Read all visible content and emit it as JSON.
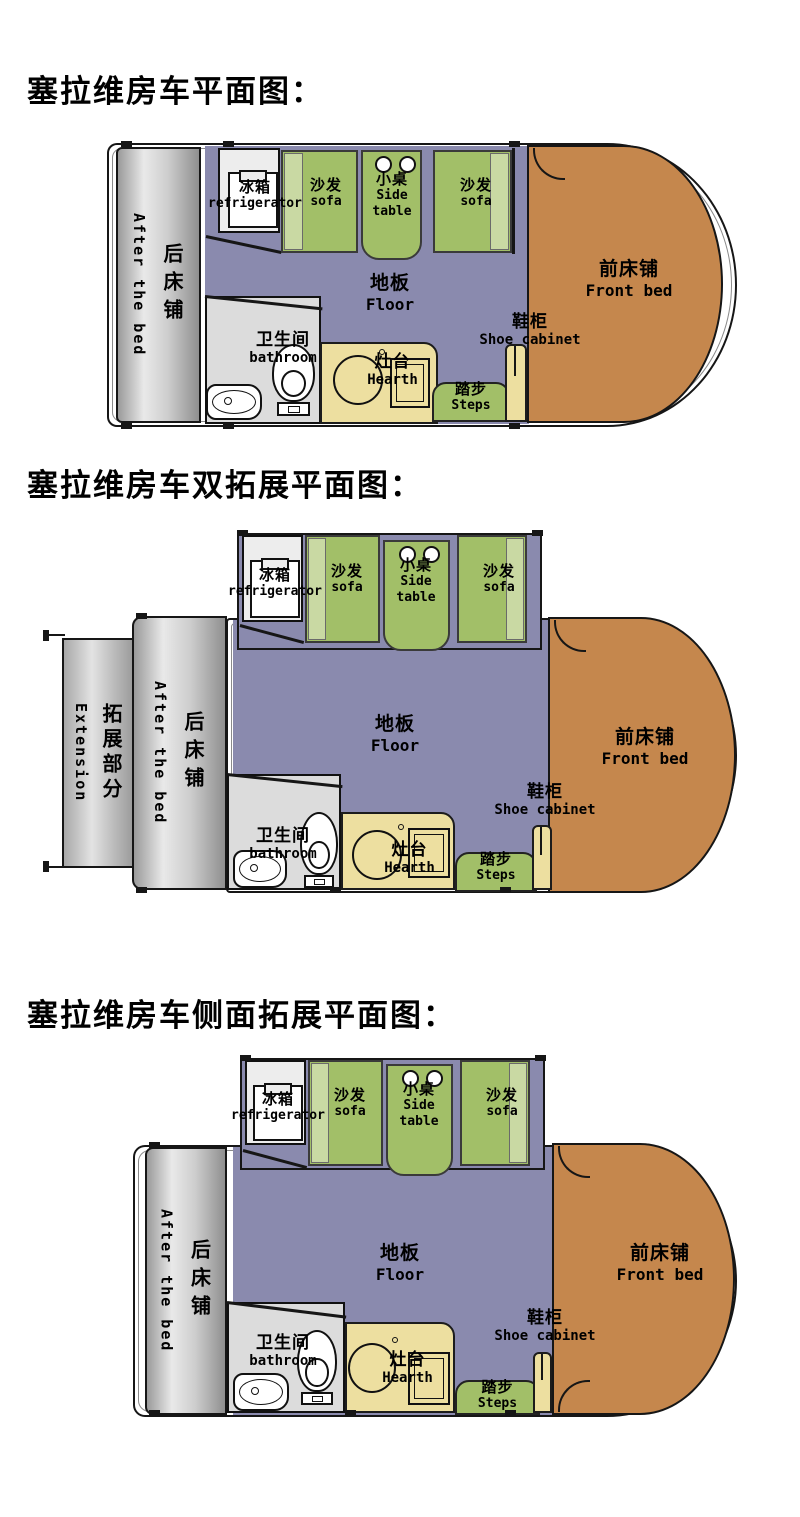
{
  "titles": {
    "plan1": "塞拉维房车平面图：",
    "plan2": "塞拉维房车双拓展平面图：",
    "plan3": "塞拉维房车侧面拓展平面图："
  },
  "labels": {
    "rear_bed": {
      "cn": "后床铺",
      "en": "After the bed"
    },
    "extension": {
      "cn": "拓展部分",
      "en": "Extension"
    },
    "refrigerator": {
      "cn": "冰箱",
      "en": "refrigerator"
    },
    "sofa": {
      "cn": "沙发",
      "en": "sofa"
    },
    "side_table": {
      "cn": "小桌",
      "en_line1": "Side",
      "en_line2": "table"
    },
    "floor": {
      "cn": "地板",
      "en": "Floor"
    },
    "bathroom": {
      "cn": "卫生间",
      "en": "bathroom"
    },
    "hearth": {
      "cn": "灶台",
      "en": "Hearth"
    },
    "steps": {
      "cn": "踏步",
      "en": "Steps"
    },
    "shoe_cabinet": {
      "cn": "鞋柜",
      "en": "Shoe cabinet"
    },
    "front_bed": {
      "cn": "前床铺",
      "en": "Front bed"
    }
  },
  "colors": {
    "floor_purple": "#8a8aae",
    "sofa_green": "#a2bf68",
    "sofa_green_light": "#c9d9a3",
    "front_bed_orange": "#c5874d",
    "counter_yellow": "#eddfa0",
    "bathroom_gray": "#dcdcdc",
    "bed_gray_gradient": "#9a9a9a-#e9e9e9-#8f8f8f",
    "outline_black": "#161616",
    "background": "#ffffff"
  }
}
